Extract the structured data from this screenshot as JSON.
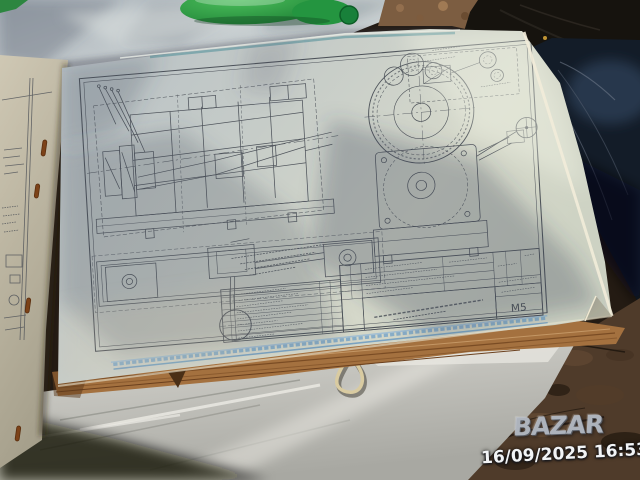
{
  "watermark": {
    "logo": "BAZAR",
    "timestamp": "16/09/2025 16:53"
  },
  "drawing": {
    "sheet_code": "М5"
  },
  "colors": {
    "page": "#c9cfc7",
    "table_surface": "#c3cacd",
    "blue_edge_band": "#7fa9c8",
    "page_stack_edge": "#a4713f",
    "dirt_ground": "#5a4330",
    "denim": "#18222e",
    "bottle_green": "#2a9d44",
    "drawing_ink": "#3d424b",
    "watermark_gray": "#b7bcc3",
    "timestamp_white": "#f2f4f6"
  }
}
